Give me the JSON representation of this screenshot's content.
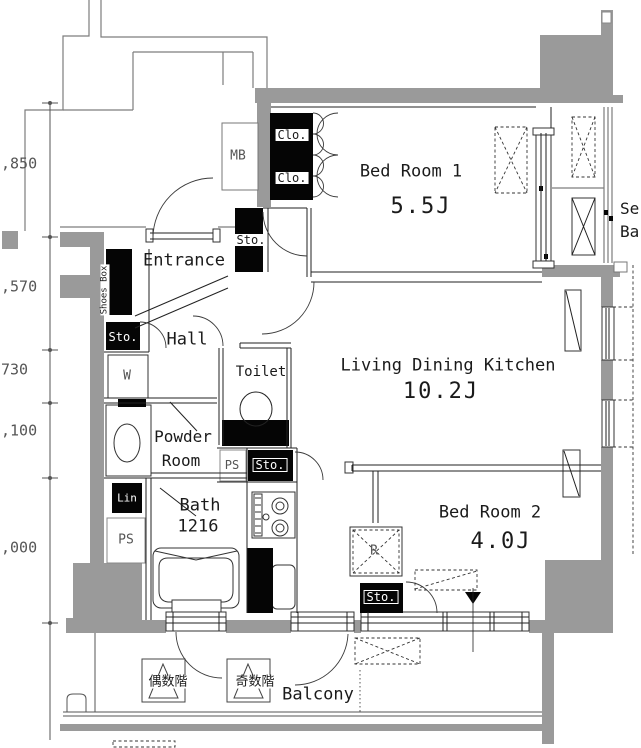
{
  "title": "apartment-floor-plan",
  "colors": {
    "wall": "#9a9a9a",
    "line": "#222222",
    "thin": "#7d7d7d",
    "black": "#050505"
  },
  "rooms": {
    "bed1": {
      "name": "Bed Room 1",
      "area": "5.5J"
    },
    "ldk": {
      "name": "Living Dining Kitchen",
      "area": "10.2J"
    },
    "bed2": {
      "name": "Bed Room 2",
      "area": "4.0J"
    },
    "entrance": {
      "name": "Entrance"
    },
    "hall": {
      "name": "Hall"
    },
    "toilet": {
      "name": "Toilet"
    },
    "powder": {
      "name_line1": "Powder",
      "name_line2": "Room"
    },
    "bath": {
      "name": "Bath",
      "size": "1216"
    },
    "balcony": {
      "name": "Balcony"
    },
    "service_balcony": {
      "name_line1": "Se",
      "name_line2": "Ba"
    }
  },
  "labels": {
    "mb": "MB",
    "washer": "W",
    "ps_west": "PS",
    "ps_toilet": "PS",
    "fridge": "R",
    "shoes_box": "Shoes Box",
    "clo1": "Clo.",
    "clo2": "Clo.",
    "sto_bed1": "Sto.",
    "sto_hall": "Sto.",
    "sto_kitchen": "Sto.",
    "sto_bed2": "Sto.",
    "linen": "Lin"
  },
  "floor_markers": {
    "even": "偶数階",
    "odd": "奇数階"
  },
  "dimensions": {
    "labels": [
      ",850",
      ",570",
      "730",
      ",100",
      ",000"
    ]
  }
}
